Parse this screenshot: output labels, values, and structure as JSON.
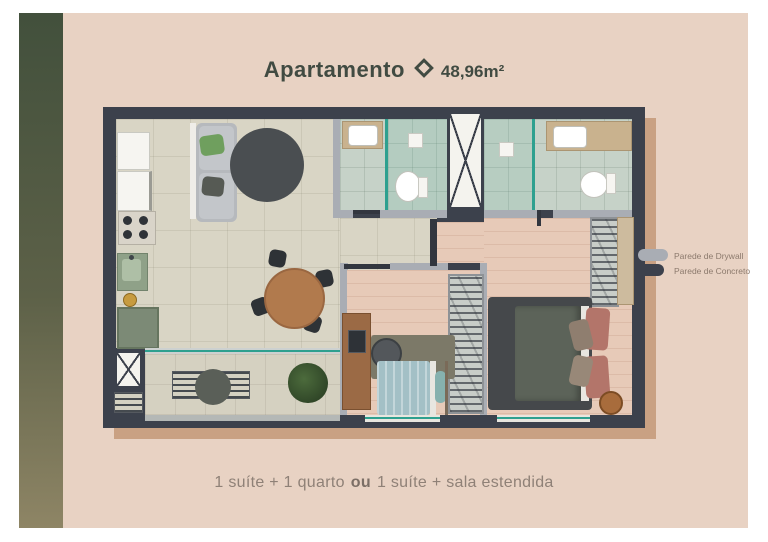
{
  "header": {
    "title": "Apartamento",
    "separator_icon": "diamond-icon",
    "area": "48,96m²"
  },
  "legend": {
    "items": [
      {
        "label": "Parede de Drywall",
        "color": "#a9adb4"
      },
      {
        "label": "Parede de Concreto",
        "color": "#3c414c"
      }
    ]
  },
  "caption": {
    "before": "1 suíte + 1 quarto",
    "connector": "ou",
    "after": "1 suíte + sala estendida"
  },
  "floorplan": {
    "colors": {
      "panel_background": "#e8d2c3",
      "accent_strip_top": "#42503c",
      "accent_strip_bottom": "#8e8565",
      "concrete_wall": "#3c414c",
      "drywall": "#a9adb4",
      "tile_floor": "#d9d5c5",
      "wood_floor": "#e7cab8",
      "bath_floor": "#c6d2c8",
      "glass": "#2ea08f",
      "plan_shadow": "#c9a183"
    }
  }
}
